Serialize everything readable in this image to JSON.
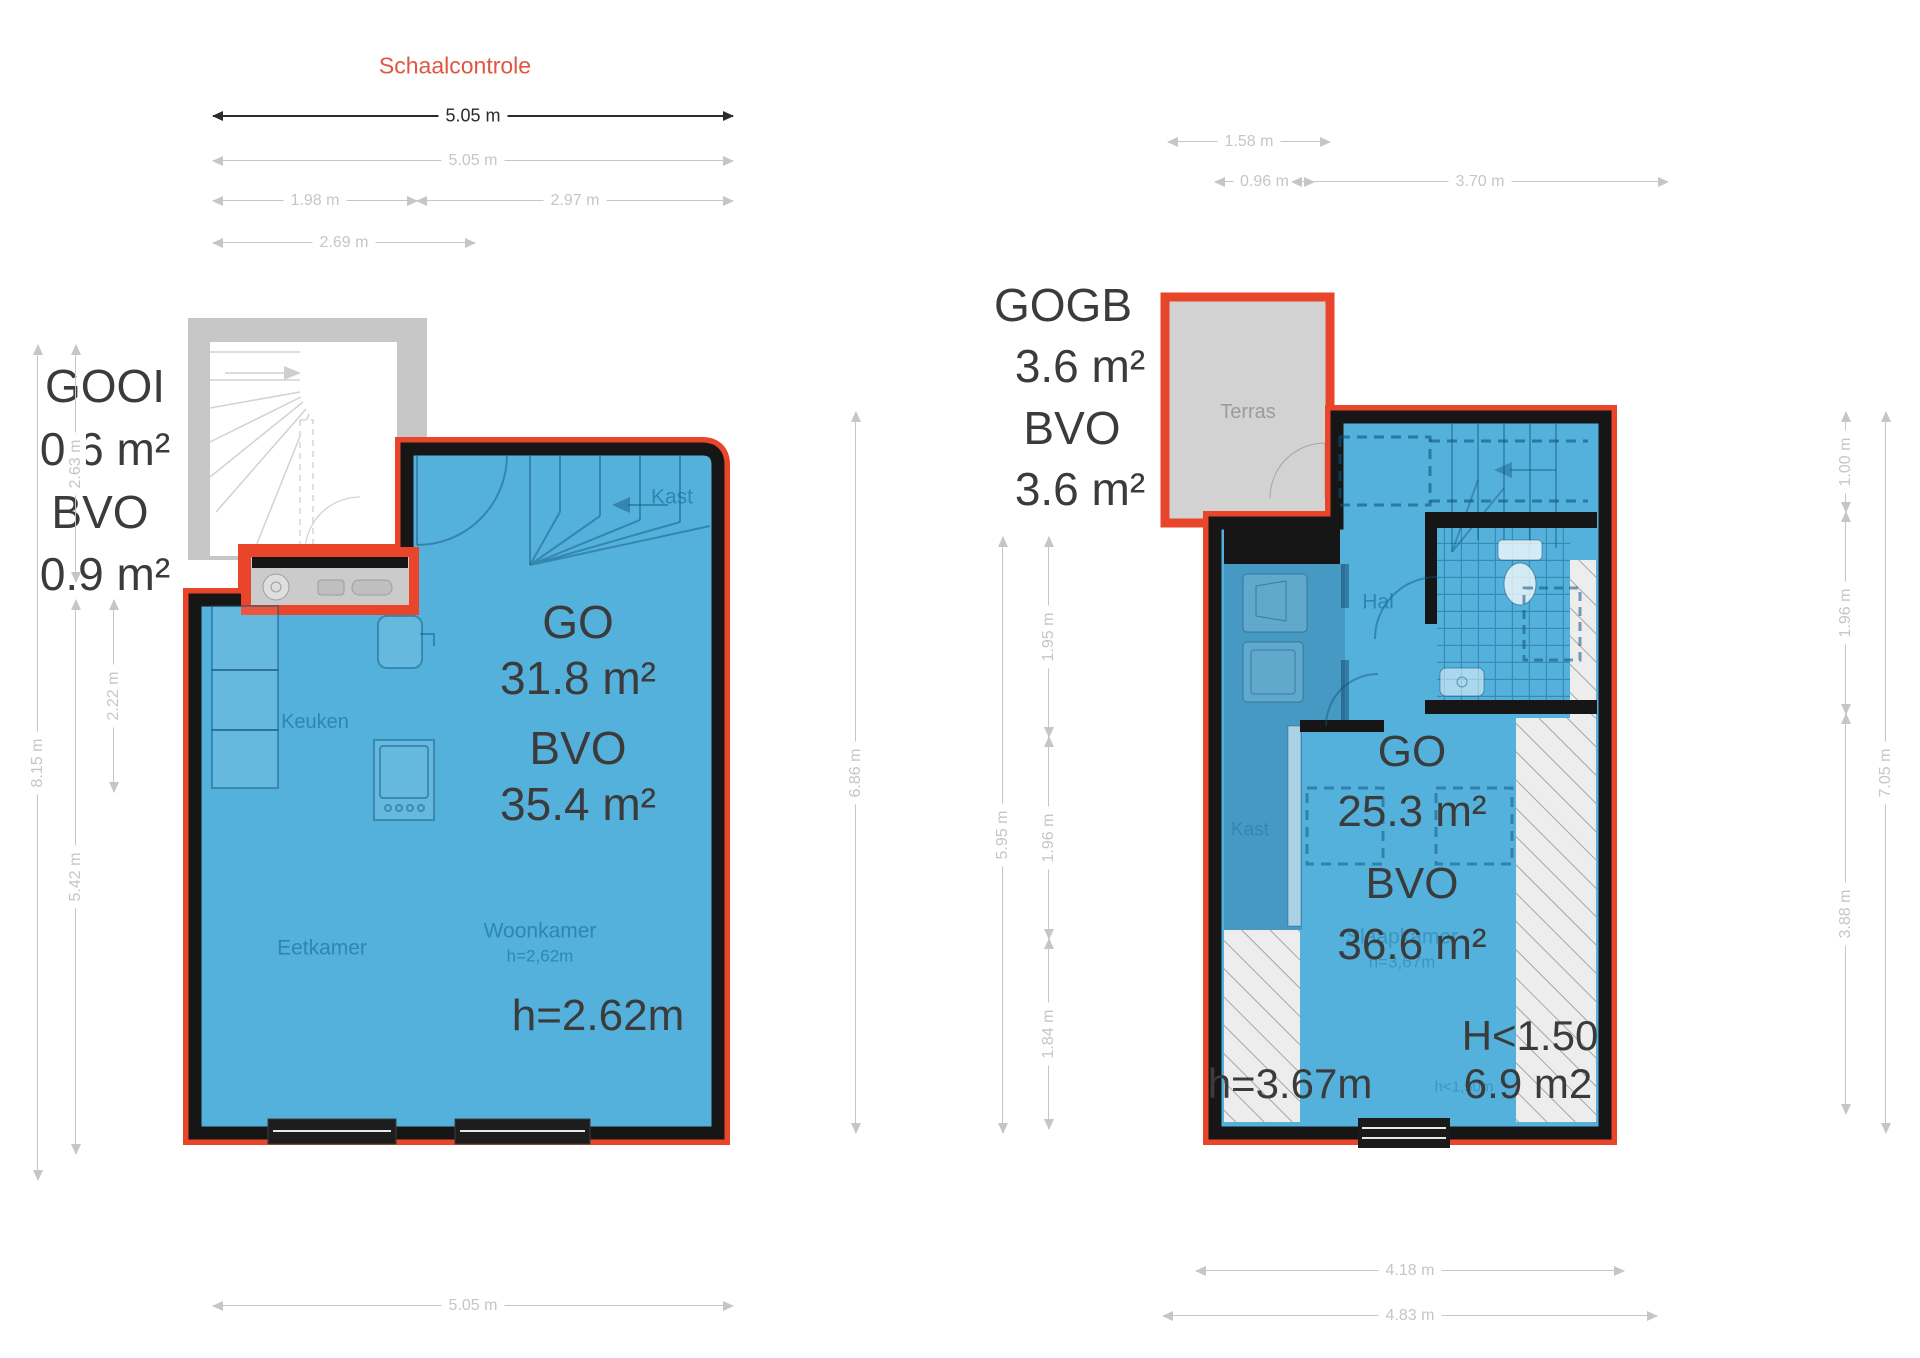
{
  "scale_check_label": "Schaalcontrole",
  "palette": {
    "accent_red": "#e8452a",
    "floor_blue": "#54b1dc",
    "wall_black": "#161616",
    "terrace_gray": "#d2d2d2",
    "dim_gray": "#c6c6c6",
    "text_dark": "#3b3b3b",
    "room_label_blue": "#1b6c96",
    "scale_check_red": "#dd5741"
  },
  "left_unit": {
    "summary_block": [
      "GOOI",
      "0.6 m²",
      "BVO",
      "0.9 m²"
    ],
    "area_block": [
      "GO",
      "31.8 m²",
      "BVO",
      "35.4 m²"
    ],
    "ceiling_height": "h=2.62m",
    "rooms": [
      "Kast",
      "Keuken",
      "Eetkamer",
      "Woonkamer"
    ]
  },
  "right_unit": {
    "summary_block": [
      "GOGB",
      "3.6 m²",
      "BVO",
      "3.6 m²"
    ],
    "area_block": [
      "GO",
      "25.3 m²",
      "BVO",
      "36.6 m²"
    ],
    "ceiling_height": "h=3.67m",
    "low_headroom": [
      "H<1.50",
      "6.9 m2"
    ],
    "rooms": [
      "Terras",
      "Hal",
      "Kast",
      "Slaapkamer"
    ]
  },
  "labels": [
    {
      "n": "left-unit-gooi",
      "t": "GOOI",
      "x": 105,
      "y": 386,
      "s": 46,
      "cls": "big"
    },
    {
      "n": "left-unit-gooi-area",
      "t": "0.6 m²",
      "x": 105,
      "y": 449,
      "s": 46,
      "cls": "big"
    },
    {
      "n": "left-unit-bvo-label",
      "t": "BVO",
      "x": 100,
      "y": 512,
      "s": 46,
      "cls": "big"
    },
    {
      "n": "left-unit-bvo-area",
      "t": "0.9 m²",
      "x": 105,
      "y": 574,
      "s": 46,
      "cls": "big"
    },
    {
      "n": "left-room-kast",
      "t": "Kast",
      "x": 672,
      "y": 497,
      "s": 21,
      "cls": "room"
    },
    {
      "n": "left-room-keuken",
      "t": "Keuken",
      "x": 315,
      "y": 722,
      "s": 20,
      "cls": "room"
    },
    {
      "n": "left-room-eetkamer",
      "t": "Eetkamer",
      "x": 322,
      "y": 948,
      "s": 21,
      "cls": "room"
    },
    {
      "n": "left-room-woonkamer",
      "t": "Woonkamer",
      "x": 540,
      "y": 931,
      "s": 21,
      "cls": "room"
    },
    {
      "n": "left-room-woonkamer-height",
      "t": "h=2,62m",
      "x": 540,
      "y": 956,
      "s": 17,
      "cls": "room"
    },
    {
      "n": "left-go-label",
      "t": "GO",
      "x": 578,
      "y": 622,
      "s": 46,
      "cls": "big"
    },
    {
      "n": "left-go-area",
      "t": "31.8 m²",
      "x": 578,
      "y": 678,
      "s": 46,
      "cls": "big"
    },
    {
      "n": "left-bvo-label",
      "t": "BVO",
      "x": 578,
      "y": 748,
      "s": 46,
      "cls": "big"
    },
    {
      "n": "left-bvo-area",
      "t": "35.4 m²",
      "x": 578,
      "y": 804,
      "s": 46,
      "cls": "big"
    },
    {
      "n": "left-ceiling-height",
      "t": "h=2.62m",
      "x": 598,
      "y": 1016,
      "s": 44,
      "cls": "big"
    },
    {
      "n": "right-unit-gogb",
      "t": "GOGB",
      "x": 1063,
      "y": 305,
      "s": 46,
      "cls": "big"
    },
    {
      "n": "right-unit-gogb-area",
      "t": "3.6 m²",
      "x": 1080,
      "y": 366,
      "s": 46,
      "cls": "big"
    },
    {
      "n": "right-unit-bvo-label",
      "t": "BVO",
      "x": 1072,
      "y": 428,
      "s": 46,
      "cls": "big"
    },
    {
      "n": "right-unit-bvo-area",
      "t": "3.6 m²",
      "x": 1080,
      "y": 489,
      "s": 46,
      "cls": "big"
    },
    {
      "n": "right-room-terras",
      "t": "Terras",
      "x": 1248,
      "y": 412,
      "s": 20,
      "cls": "gray"
    },
    {
      "n": "right-room-hal",
      "t": "Hal",
      "x": 1378,
      "y": 602,
      "s": 21,
      "cls": "room"
    },
    {
      "n": "right-room-kast",
      "t": "Kast",
      "x": 1250,
      "y": 830,
      "s": 19,
      "cls": "room faint"
    },
    {
      "n": "right-room-slaapkamer",
      "t": "Slaapkamer",
      "x": 1402,
      "y": 937,
      "s": 21,
      "cls": "room faint"
    },
    {
      "n": "right-room-slaapkamer-height",
      "t": "h=3,67m",
      "x": 1402,
      "y": 962,
      "s": 17,
      "cls": "room faint"
    },
    {
      "n": "right-go-label",
      "t": "GO",
      "x": 1412,
      "y": 752,
      "s": 44,
      "cls": "big"
    },
    {
      "n": "right-go-area",
      "t": "25.3 m²",
      "x": 1412,
      "y": 812,
      "s": 44,
      "cls": "big"
    },
    {
      "n": "right-bvo-label",
      "t": "BVO",
      "x": 1412,
      "y": 884,
      "s": 44,
      "cls": "big"
    },
    {
      "n": "right-bvo-area",
      "t": "36.6 m²",
      "x": 1412,
      "y": 945,
      "s": 44,
      "cls": "big"
    },
    {
      "n": "right-ceiling-height",
      "t": "h=3.67m",
      "x": 1290,
      "y": 1084,
      "s": 42,
      "cls": "big"
    },
    {
      "n": "right-low-height-faint",
      "t": "h<1,50m",
      "x": 1464,
      "y": 1087,
      "s": 15,
      "cls": "room faint"
    },
    {
      "n": "right-low-height-label",
      "t": "H<1.50",
      "x": 1530,
      "y": 1036,
      "s": 42,
      "cls": "big"
    },
    {
      "n": "right-low-height-area",
      "t": "6.9 m2",
      "x": 1528,
      "y": 1084,
      "s": 42,
      "cls": "big"
    }
  ],
  "dimensions": [
    {
      "n": "dim-scalecheck-505",
      "t": "5.05 m",
      "o": "h",
      "x": 213,
      "y": 115,
      "len": 520,
      "dark": true
    },
    {
      "n": "dim-top-505",
      "t": "5.05 m",
      "o": "h",
      "x": 213,
      "y": 160,
      "len": 520
    },
    {
      "n": "dim-top-198",
      "t": "1.98 m",
      "o": "h",
      "x": 213,
      "y": 200,
      "len": 204
    },
    {
      "n": "dim-top-297",
      "t": "2.97 m",
      "o": "h",
      "x": 417,
      "y": 200,
      "len": 316
    },
    {
      "n": "dim-top-269",
      "t": "2.69 m",
      "o": "h",
      "x": 213,
      "y": 242,
      "len": 262
    },
    {
      "n": "dim-left-815",
      "t": "8.15 m",
      "o": "v",
      "x": 37,
      "y": 345,
      "len": 835
    },
    {
      "n": "dim-left-263",
      "t": "2.63 m",
      "o": "v",
      "x": 75,
      "y": 345,
      "len": 237
    },
    {
      "n": "dim-left-542",
      "t": "5.42 m",
      "o": "v",
      "x": 75,
      "y": 600,
      "len": 554
    },
    {
      "n": "dim-left-222",
      "t": "2.22 m",
      "o": "v",
      "x": 113,
      "y": 600,
      "len": 192
    },
    {
      "n": "dim-mid-686",
      "t": "6.86 m",
      "o": "v",
      "x": 855,
      "y": 412,
      "len": 721
    },
    {
      "n": "dim-rplan-595",
      "t": "5.95 m",
      "o": "v",
      "x": 1002,
      "y": 537,
      "len": 596
    },
    {
      "n": "dim-rplan-195",
      "t": "1.95 m",
      "o": "v",
      "x": 1048,
      "y": 537,
      "len": 200
    },
    {
      "n": "dim-rplan-196",
      "t": "1.96 m",
      "o": "v",
      "x": 1048,
      "y": 737,
      "len": 202
    },
    {
      "n": "dim-rplan-184",
      "t": "1.84 m",
      "o": "v",
      "x": 1048,
      "y": 939,
      "len": 190
    },
    {
      "n": "dim-right-100",
      "t": "1.00 m",
      "o": "v",
      "x": 1845,
      "y": 412,
      "len": 100
    },
    {
      "n": "dim-right-196",
      "t": "1.96 m",
      "o": "v",
      "x": 1845,
      "y": 512,
      "len": 202
    },
    {
      "n": "dim-right-388",
      "t": "3.88 m",
      "o": "v",
      "x": 1845,
      "y": 714,
      "len": 400
    },
    {
      "n": "dim-right-705",
      "t": "7.05 m",
      "o": "v",
      "x": 1885,
      "y": 412,
      "len": 721
    },
    {
      "n": "dim-topright-158",
      "t": "1.58 m",
      "o": "h",
      "x": 1168,
      "y": 141,
      "len": 162
    },
    {
      "n": "dim-topright-096",
      "t": "0.96 m",
      "o": "h",
      "x": 1215,
      "y": 181,
      "len": 99
    },
    {
      "n": "dim-topright-370",
      "t": "3.70 m",
      "o": "h",
      "x": 1292,
      "y": 181,
      "len": 376
    },
    {
      "n": "dim-bottom-505",
      "t": "5.05 m",
      "o": "h",
      "x": 213,
      "y": 1305,
      "len": 520
    },
    {
      "n": "dim-bottom-418",
      "t": "4.18 m",
      "o": "h",
      "x": 1196,
      "y": 1270,
      "len": 428
    },
    {
      "n": "dim-bottom-483",
      "t": "4.83 m",
      "o": "h",
      "x": 1163,
      "y": 1315,
      "len": 494
    }
  ]
}
